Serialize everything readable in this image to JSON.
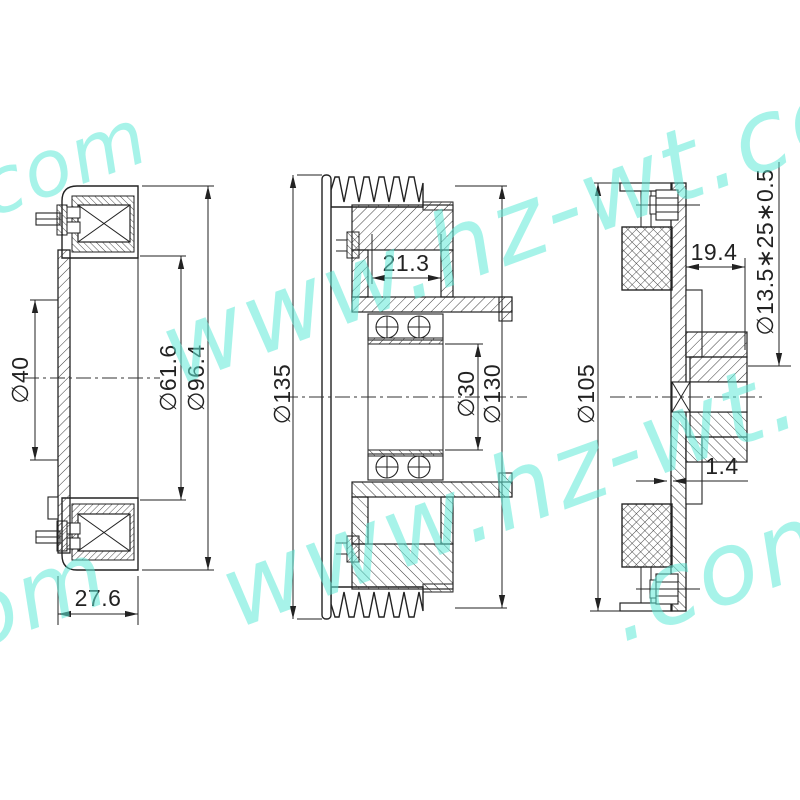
{
  "watermark": {
    "color": "rgba(95,233,215,0.55)",
    "fragments": [
      {
        "text": "com"
      },
      {
        "text": "www.hz-wt.com"
      },
      {
        "text": "www.hz-wt."
      },
      {
        "text": ".com"
      },
      {
        "text": "om"
      }
    ]
  },
  "views": {
    "coil": {
      "dims": {
        "bore": "∅40",
        "coil_od": "∅61.6",
        "outer": "∅96.4",
        "width": "27.6"
      }
    },
    "pulley": {
      "dims": {
        "outer": "∅135",
        "hub_width": "21.3",
        "bore": "∅30",
        "rim": "∅130"
      }
    },
    "hub": {
      "dims": {
        "outer": "∅105",
        "depth": "19.4",
        "spline": "∅13.5∗25∗0.5",
        "gap": "1.4"
      }
    }
  }
}
